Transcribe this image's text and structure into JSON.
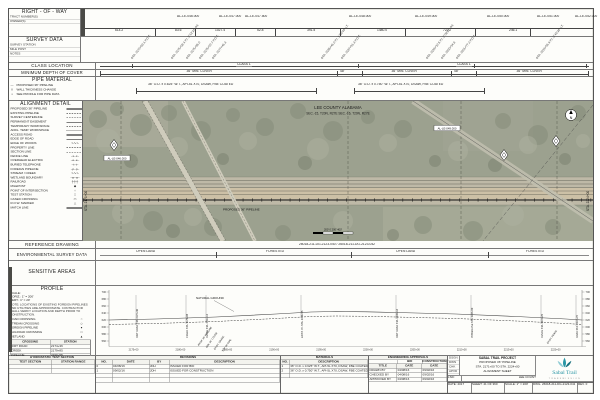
{
  "row_band": {
    "title": "RIGHT - OF - WAY",
    "fields": [
      "TRACT NUMBER(S)",
      "OWNER(S)"
    ],
    "tracts": [
      "AL-LE-046.000",
      "AL-LE-047.000",
      "AL-LE-047.500",
      "AL-LE-048.000",
      "AL-LE-049.000",
      "AL-LE-050.000",
      "AL-LE-051.000",
      "AL-LE-052.000"
    ],
    "dims": [
      "614.2",
      "83.6",
      "1027.4",
      "52.8",
      "391.5",
      "1480.0",
      "722.7",
      "246.1"
    ]
  },
  "survey_band": {
    "title": "SURVEY DATA",
    "fields": [
      "SURVEY STATION",
      "MILE POST",
      "NOTES"
    ],
    "callouts": [
      "STA. 2172+63.1 P.O.T.",
      "STA. 2175+08.4 P.I. 3°12'14\" RT.",
      "STA. 2175+86.0",
      "STA. 2176+22.7 P.O.T.",
      "STA. 2177+45.3",
      "STA. 2186+45.0 P.I. 1°55'40\" LT.",
      "STA. 2187+91.3 P.O.T.",
      "STA. 2199+12.6 P.I. 2°08'52\" RT.",
      "STA. 2200+34.8",
      "STA. 2201+77.2 P.O.T.",
      "STA. 2219+55.9 P.I. 0°45'18\" LT."
    ]
  },
  "class_band": {
    "title": "CLASS LOCATION",
    "labels": [
      "CLASS 1",
      "CLASS 1"
    ]
  },
  "cover_band": {
    "title": "MINIMUM DEPTH OF COVER",
    "segments": [
      "36\" MIN. COVER",
      "48\"",
      "36\" MIN. COVER",
      "48\"",
      "36\" MIN. COVER"
    ]
  },
  "pipe_band": {
    "title": "PIPE MATERIAL",
    "legend": [
      {
        "glyph": "—",
        "label": "PROPOSED 36\" PIPELINE"
      },
      {
        "glyph": "‖",
        "label": "WALL THICKNESS CHANGE"
      },
      {
        "glyph": "▪",
        "label": "SEE PROFILE FOR PIPE DATA"
      }
    ],
    "specs": [
      "36\" O.D. x 0.625\" W.T., API-5L X70, DSAW, FBE COATED",
      "36\" O.D. x 0.750\" W.T., API-5L X70, DSAW, FBE COATED"
    ]
  },
  "alignment_detail": {
    "title": "ALIGNMENT DETAIL",
    "items": [
      {
        "label": "PROPOSED 36\" PIPELINE",
        "style": "bold"
      },
      {
        "label": "EXISTING PIPELINE",
        "style": "dashed"
      },
      {
        "label": "SURVEY CENTERLINE",
        "style": "dashdot"
      },
      {
        "label": "PERMANENT EASEMENT",
        "style": "solid"
      },
      {
        "label": "TEMPORARY WORKSPACE",
        "style": "dashed"
      },
      {
        "label": "ADDL. TEMP. WORKSPACE",
        "style": "dotted"
      },
      {
        "label": "ACCESS ROAD",
        "style": "double"
      },
      {
        "label": "EDGE OF ROAD",
        "style": "solid"
      },
      {
        "label": "EDGE OF WOODS",
        "glyph": "∿∿∿"
      },
      {
        "label": "PROPERTY LINE",
        "style": "dashed"
      },
      {
        "label": "SECTION LINE",
        "style": "dashdot"
      },
      {
        "label": "FENCE LINE",
        "glyph": "–x–x–"
      },
      {
        "label": "OVERHEAD ELECTRIC",
        "glyph": "–e–e–"
      },
      {
        "label": "BURIED TELEPHONE",
        "glyph": "–t–t–"
      },
      {
        "label": "FOREIGN PIPELINE",
        "glyph": "–p–p–"
      },
      {
        "label": "STREAM / CREEK",
        "glyph": "∿∿∿"
      },
      {
        "label": "WETLAND BOUNDARY",
        "glyph": "–w–w–"
      },
      {
        "label": "RAILROAD",
        "glyph": "┼┼┼"
      },
      {
        "label": "MILEPOST",
        "glyph": "◆"
      },
      {
        "label": "POINT OF INTERSECTION",
        "glyph": "○"
      },
      {
        "label": "TEST STATION",
        "glyph": "□"
      },
      {
        "label": "CASED CROSSING",
        "glyph": "▭"
      },
      {
        "label": "R.O.W. MARKER",
        "glyph": "△"
      },
      {
        "label": "MATCH LINE",
        "style": "bold"
      }
    ]
  },
  "map": {
    "county": "LEE COUNTY ALABAMA",
    "sections": "SEC.-15, T20N, R27E        SEC.-16, T20N, R27E",
    "north": "N",
    "tags": [
      "AL-LE-046.000",
      "AL-LE-049.000"
    ],
    "pipeline_label": "PROPOSED 36\" PIPELINE",
    "matchline_left": "STA. 2171+00",
    "matchline_right": "STA. 2224+00",
    "scale_bar": "200'    0    200'    400'"
  },
  "reference_band": {
    "title": "REFERENCE DRAWING",
    "note": "26018-211-DG-2123-040   /   26018-211-DG-2123-042"
  },
  "environmental_band": {
    "title": "ENVIRONMENTAL SURVEY DATA",
    "segments": [
      "OPEN LAND",
      "FORESTED",
      "OPEN LAND",
      "FORESTED"
    ]
  },
  "sensitive_band": {
    "title": "SENSITIVE AREAS"
  },
  "profile": {
    "title": "PROFILE",
    "scale_lines": [
      "SCALE:",
      "HORIZ.: 1\" = 200'",
      "VERT.: 1\" = 20'"
    ],
    "note": "NOTE: LOCATIONS OF EXISTING FOREIGN PIPELINES AND UTILITIES ARE APPROXIMATE. CONTRACTOR SHALL VERIFY LOCATION AND DEPTH PRIOR TO CONSTRUCTION.",
    "natural_ground": "NATURAL GROUND",
    "elev_ticks": [
      "700",
      "680",
      "660",
      "640",
      "620",
      "600",
      "580",
      "560"
    ],
    "event_labels": [
      "DIRT ROAD STA. 2174+36",
      "CREEK STA. 2179+85",
      "FENCE STA. 2181+10",
      "EXIST. P/L STA. 2190+55",
      "DIRT ROAD STA. 2200+18",
      "POWERLINE STA. 2207+90",
      "FENCE STA. 2215+25",
      "ROAD STA. 2219+70"
    ],
    "diag_labels": [
      "PROP. 36\" PIPELINE",
      "MIN. 36\" COVER",
      "EXIST. GRADE",
      "TOP OF PIPE",
      "EXIST. FENCE"
    ],
    "station_labels": [
      "2175+00",
      "2180+00",
      "2185+00",
      "2190+00",
      "2195+00",
      "2200+00",
      "2205+00",
      "2210+00",
      "2215+00",
      "2220+00"
    ],
    "crossing_legend": [
      {
        "label": "ROAD CROSSING",
        "glyph": "○"
      },
      {
        "label": "STREAM CROSSING",
        "glyph": "◇"
      },
      {
        "label": "FOREIGN PIPELINE",
        "glyph": "●"
      },
      {
        "label": "RAILROAD CROSSING",
        "glyph": "□"
      },
      {
        "label": "WETLAND",
        "glyph": "▲"
      }
    ],
    "crossing_table": [
      [
        "CROSSING",
        "STATION"
      ],
      [
        "DIRT ROAD",
        "2174+36"
      ],
      [
        "CREEK",
        "2179+85"
      ],
      [
        "PIPELINE",
        "2190+55"
      ],
      [
        "POWERLINE",
        "2207+90"
      ]
    ]
  },
  "hydro": {
    "title": "HYDROSTATIC TEST SECTION",
    "table": [
      [
        "TEST SECTION",
        "STATION RANGE"
      ],
      [
        "",
        ""
      ],
      [
        "",
        ""
      ]
    ]
  },
  "revisions": {
    "title": "REVISIONS",
    "table": [
      [
        "NO.",
        "DATE",
        "BY",
        "DESCRIPTION"
      ],
      [
        "0",
        "04/08/16",
        "JDH",
        "ISSUED FOR BID"
      ],
      [
        "1",
        "09/02/16",
        "JDH",
        "ISSUED FOR CONSTRUCTION"
      ],
      [
        "",
        "",
        "",
        ""
      ],
      [
        "",
        "",
        "",
        ""
      ]
    ]
  },
  "materials": {
    "title": "MATERIALS",
    "table": [
      [
        "NO.",
        "DESCRIPTION"
      ],
      [
        "1",
        "36\" O.D. x 0.625\" W.T., API-5L X70, DSAW, FBE COATED"
      ],
      [
        "2",
        "36\" O.D. x 0.750\" W.T., API-5L X70, DSAW, FBE COATED"
      ],
      [
        "",
        ""
      ]
    ]
  },
  "approvals": {
    "title": "ENGINEERING APPROVALS",
    "groups": [
      "BID",
      "CONSTRUCTION"
    ],
    "table": [
      [
        "TITLE",
        "DATE",
        "DATE"
      ],
      [
        "DRAWN BY",
        "04/08/16",
        "09/02/16"
      ],
      [
        "CHECKED BY",
        "04/08/16",
        "09/02/16"
      ],
      [
        "APPROVED BY",
        "04/08/16",
        "09/02/16"
      ]
    ]
  },
  "titleblock": {
    "project_lines": [
      "SABAL TRAIL PROJECT",
      "PROPOSED 36\" PIPELINE",
      "STA. 2171+00 TO STA. 2224+00",
      "ALIGNMENT SHEET"
    ],
    "left_rows": [
      "DSGN",
      "DWN",
      "CHK",
      "APVD"
    ],
    "lsd_label": "LSD:",
    "county": "LEE COUNTY, ALABAMA",
    "date_label": "DATE:",
    "date": "2017",
    "sheet_label": "SHEET:",
    "sheet": "41 OF 360",
    "scale_label": "SCALE:",
    "scale": "1\" = 200'",
    "dwg_label": "DWG.",
    "dwg": "26018-211-DG-2123-041",
    "rev_label": "REV.",
    "rev": "0",
    "logo": {
      "name": "Sabal Trail",
      "sub": "T R A N S M I S S I O N",
      "color": "#2a96a5",
      "color_dark": "#16707e",
      "color_light": "#8ecbd4"
    }
  }
}
